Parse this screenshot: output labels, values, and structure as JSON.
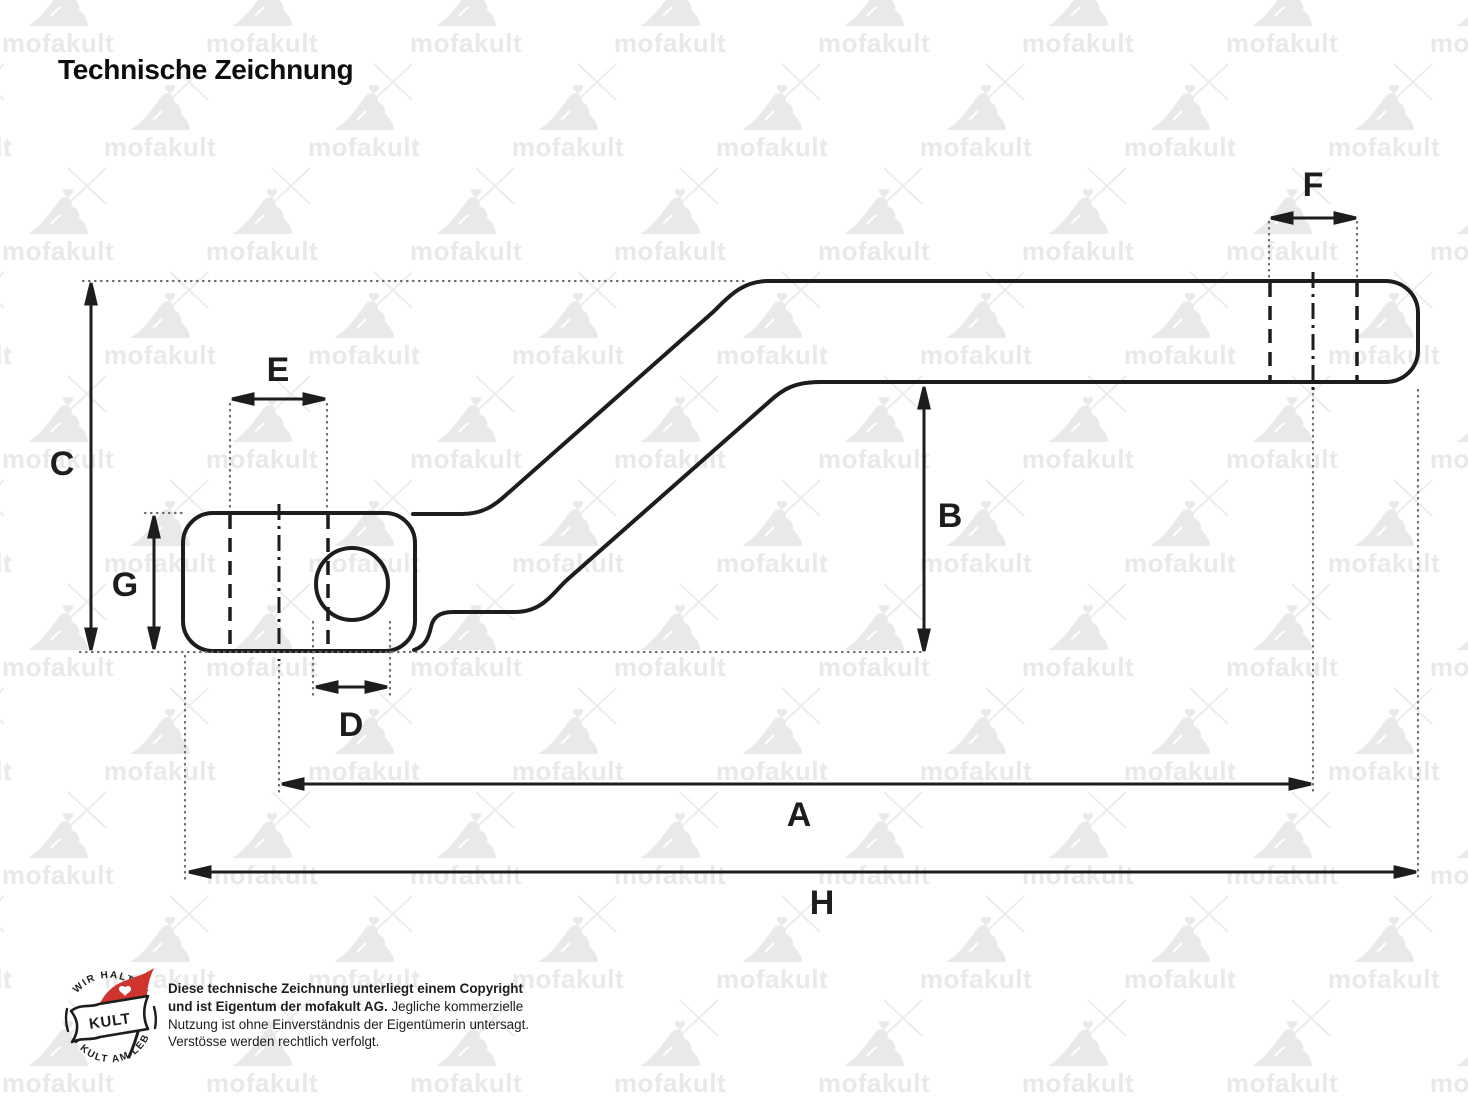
{
  "title": "Technische Zeichnung",
  "watermark": {
    "text": "mofakult"
  },
  "drawing": {
    "labels": {
      "A": "A",
      "B": "B",
      "C": "C",
      "D": "D",
      "E": "E",
      "F": "F",
      "G": "G",
      "H": "H"
    },
    "colors": {
      "line": "#1d1d1b",
      "extension": "#6a6a6a",
      "watermark": "#e9e9e9"
    }
  },
  "footer": {
    "badge": {
      "top_text": "WIR HALTEN",
      "bottom_text": "DEN KULT AM LEBEN",
      "flag_text": "KULT",
      "flag_color": "#cf342e"
    },
    "copyright_lines": [
      {
        "b": "Diese technische Zeichnung unterliegt einem Copyright",
        "r": ""
      },
      {
        "b": "und ist Eigentum der mofakult AG.",
        "r": " Jegliche kommerzielle"
      },
      {
        "b": "",
        "r": "Nutzung ist ohne Einverständnis der Eigentümerin untersagt."
      },
      {
        "b": "",
        "r": "Verstösse werden rechtlich verfolgt."
      }
    ]
  }
}
